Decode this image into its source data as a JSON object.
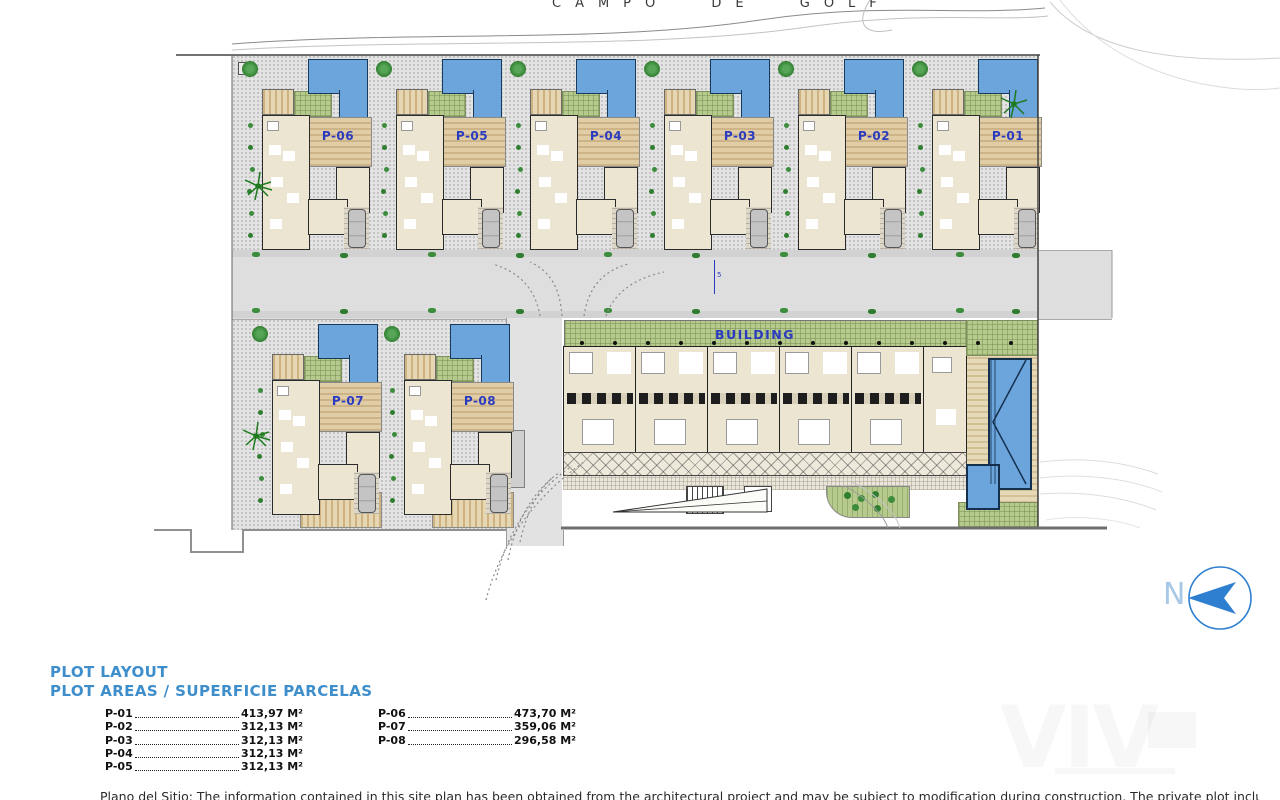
{
  "header": {
    "golf_course_label": "CAMPO DE GOLF"
  },
  "plan": {
    "villas": [
      {
        "label": "P-06"
      },
      {
        "label": "P-05"
      },
      {
        "label": "P-04"
      },
      {
        "label": "P-03"
      },
      {
        "label": "P-02"
      },
      {
        "label": "P-01"
      },
      {
        "label": "P-07"
      },
      {
        "label": "P-08"
      }
    ],
    "building_label": "BUILDING",
    "road_annotation": "5"
  },
  "compass": {
    "label": "N"
  },
  "legend": {
    "title_line1": "PLOT LAYOUT",
    "title_line2": "PLOT AREAS / SUPERFICIE PARCELAS",
    "left_column": [
      {
        "plot": "P-01",
        "area": "413,97 M²"
      },
      {
        "plot": "P-02",
        "area": "312,13 M²"
      },
      {
        "plot": "P-03",
        "area": "312,13 M²"
      },
      {
        "plot": "P-04",
        "area": "312,13 M²"
      },
      {
        "plot": "P-05",
        "area": "312,13 M²"
      }
    ],
    "right_column": [
      {
        "plot": "P-06",
        "area": "473,70 M²"
      },
      {
        "plot": "P-07",
        "area": "359,06 M²"
      },
      {
        "plot": "P-08",
        "area": "296,58 M²"
      }
    ]
  },
  "watermark": {
    "text": "VIV"
  },
  "footer": {
    "disclaimer": "Plano del Sitio: The information contained in this site plan has been obtained from the architectural project and may be subject to modification during construction. The private plot includes the delimited garden and parking areas of each family home. / Site"
  },
  "colors": {
    "pool_blue": "#6CA4DC",
    "label_blue": "#2B3BBF",
    "legend_blue": "#3E8ECC",
    "compass_blue": "#2E7FD0",
    "lawn_green": "#B7CA8E",
    "deck_tan": "#DCC9A0",
    "house_beige": "#ECE5D2",
    "road_gray": "#DEDEDE"
  }
}
